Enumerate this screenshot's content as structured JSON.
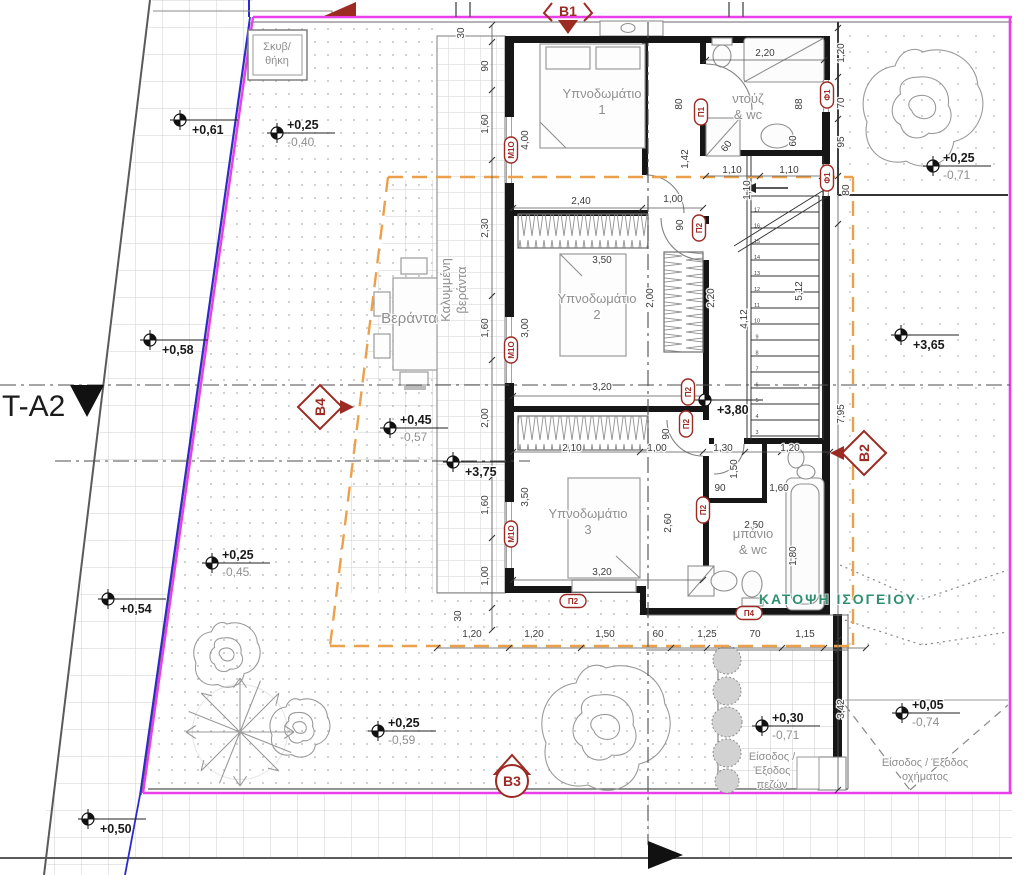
{
  "drawing": {
    "plan_title": "ΚΑΤΟΨΗ ΙΣΟΓΕΙΟΥ",
    "section_line_label": "T-A2",
    "colors": {
      "boundary": "#e93ee9",
      "setback": "#eda04b",
      "section_marker": "#9c2b24",
      "title_green": "#2f9070",
      "parcel_blue": "#2a2ad0"
    },
    "rooms": [
      {
        "name": "bedroom-1",
        "lines": [
          "Υπνοδωμάτιο",
          "1"
        ],
        "x": 602,
        "y": 98
      },
      {
        "name": "shower-wc",
        "lines": [
          "ντούζ",
          "& wc"
        ],
        "x": 748,
        "y": 103
      },
      {
        "name": "bedroom-2",
        "lines": [
          "Υπνοδωμάτιο",
          "2"
        ],
        "x": 597,
        "y": 303
      },
      {
        "name": "bedroom-3",
        "lines": [
          "Υπνοδωμάτιο",
          "3"
        ],
        "x": 588,
        "y": 518
      },
      {
        "name": "bath-wc",
        "lines": [
          "μπάνιο",
          "& wc"
        ],
        "x": 753,
        "y": 538
      },
      {
        "name": "veranda",
        "lines": [
          "Βεράντα"
        ],
        "x": 409,
        "y": 323,
        "cls": "room-lg"
      },
      {
        "name": "covered-veranda",
        "lines": [
          "Καλυμμένη",
          "βεράντα"
        ],
        "x": 450,
        "y": 290,
        "rot": -90
      },
      {
        "name": "storage",
        "lines": [
          "Σκυβ/",
          "θήκη"
        ],
        "x": 277,
        "y": 50,
        "cls": "small-gray"
      }
    ],
    "entrances": [
      {
        "name": "pedestrian-entrance",
        "lines": [
          "Είσοδος /",
          "Έξοδος",
          "πεζών"
        ],
        "x": 772,
        "y": 760
      },
      {
        "name": "vehicle-entrance",
        "lines": [
          "Είσοδος / Έξοδος",
          "οχήματος"
        ],
        "x": 925,
        "y": 766
      }
    ],
    "dimensions": [
      {
        "t": "30",
        "x": 464,
        "y": 33,
        "r": -90
      },
      {
        "t": "90",
        "x": 488,
        "y": 66,
        "r": -90
      },
      {
        "t": "1,60",
        "x": 488,
        "y": 124,
        "r": -90
      },
      {
        "t": "2,30",
        "x": 488,
        "y": 228,
        "r": -90
      },
      {
        "t": "1,60",
        "x": 488,
        "y": 328,
        "r": -90
      },
      {
        "t": "2,00",
        "x": 488,
        "y": 418,
        "r": -90
      },
      {
        "t": "1,60",
        "x": 488,
        "y": 505,
        "r": -90
      },
      {
        "t": "1,00",
        "x": 488,
        "y": 576,
        "r": -90
      },
      {
        "t": "30",
        "x": 461,
        "y": 616,
        "r": -90
      },
      {
        "t": "4,00",
        "x": 528,
        "y": 140,
        "r": -90
      },
      {
        "t": "3,00",
        "x": 528,
        "y": 328,
        "r": -90
      },
      {
        "t": "3,50",
        "x": 528,
        "y": 497,
        "r": -90
      },
      {
        "t": "2,40",
        "x": 581,
        "y": 204
      },
      {
        "t": "1,00",
        "x": 673,
        "y": 202
      },
      {
        "t": "2,20",
        "x": 765,
        "y": 56
      },
      {
        "t": "80",
        "x": 682,
        "y": 104,
        "r": -90
      },
      {
        "t": "88",
        "x": 802,
        "y": 104,
        "r": -90
      },
      {
        "t": "60",
        "x": 796,
        "y": 141,
        "r": -90
      },
      {
        "t": "60",
        "x": 729,
        "y": 148,
        "r": -55
      },
      {
        "t": "1,42",
        "x": 688,
        "y": 159,
        "r": -90
      },
      {
        "t": "1,10",
        "x": 732,
        "y": 173
      },
      {
        "t": "1,10",
        "x": 789,
        "y": 173
      },
      {
        "t": "1,10",
        "x": 750,
        "y": 190,
        "r": -90
      },
      {
        "t": "90",
        "x": 683,
        "y": 225,
        "r": -90
      },
      {
        "t": "3,50",
        "x": 602,
        "y": 263
      },
      {
        "t": "2,00",
        "x": 653,
        "y": 298,
        "r": -90
      },
      {
        "t": "2,20",
        "x": 714,
        "y": 298,
        "r": -90
      },
      {
        "t": "4,12",
        "x": 747,
        "y": 319,
        "r": -90
      },
      {
        "t": "5,12",
        "x": 802,
        "y": 291,
        "r": -90
      },
      {
        "t": "3,20",
        "x": 602,
        "y": 390
      },
      {
        "t": "90",
        "x": 669,
        "y": 434,
        "r": -90
      },
      {
        "t": "2,10",
        "x": 572,
        "y": 451
      },
      {
        "t": "1,00",
        "x": 657,
        "y": 451
      },
      {
        "t": "1,30",
        "x": 723,
        "y": 451
      },
      {
        "t": "1,20",
        "x": 790,
        "y": 451
      },
      {
        "t": "1,50",
        "x": 737,
        "y": 469,
        "r": -90
      },
      {
        "t": "90",
        "x": 720,
        "y": 491
      },
      {
        "t": "1,60",
        "x": 779,
        "y": 491
      },
      {
        "t": "2,50",
        "x": 754,
        "y": 528
      },
      {
        "t": "1,80",
        "x": 796,
        "y": 556,
        "r": -90
      },
      {
        "t": "2,60",
        "x": 671,
        "y": 523,
        "r": -90
      },
      {
        "t": "3,20",
        "x": 602,
        "y": 575
      },
      {
        "t": "1,20",
        "x": 472,
        "y": 637
      },
      {
        "t": "1,20",
        "x": 534,
        "y": 637
      },
      {
        "t": "1,50",
        "x": 605,
        "y": 637
      },
      {
        "t": "60",
        "x": 658,
        "y": 637
      },
      {
        "t": "1,25",
        "x": 707,
        "y": 637
      },
      {
        "t": "70",
        "x": 755,
        "y": 637
      },
      {
        "t": "1,15",
        "x": 805,
        "y": 637
      },
      {
        "t": "1,20",
        "x": 844,
        "y": 53,
        "r": -90
      },
      {
        "t": "70",
        "x": 844,
        "y": 103,
        "r": -90
      },
      {
        "t": "95",
        "x": 844,
        "y": 142,
        "r": -90
      },
      {
        "t": "80",
        "x": 849,
        "y": 190,
        "r": -90
      },
      {
        "t": "7,95",
        "x": 844,
        "y": 414,
        "r": -90
      },
      {
        "t": "3,42",
        "x": 844,
        "y": 709,
        "r": -90
      }
    ],
    "elevation_points": [
      {
        "p": "+0,61",
        "m": "",
        "x": 180,
        "y": 120
      },
      {
        "p": "+0,25",
        "m": "-0,40",
        "x": 277,
        "y": 133
      },
      {
        "p": "+0,58",
        "m": "",
        "x": 150,
        "y": 340
      },
      {
        "p": "+0,45",
        "m": "-0,57",
        "x": 390,
        "y": 428
      },
      {
        "p": "+3,75",
        "m": "",
        "x": 453,
        "y": 462
      },
      {
        "p": "+3,80",
        "m": "",
        "x": 705,
        "y": 400
      },
      {
        "p": "+3,65",
        "m": "",
        "x": 901,
        "y": 335
      },
      {
        "p": "+0,25",
        "m": "-0,71",
        "x": 933,
        "y": 166
      },
      {
        "p": "+0,25",
        "m": "-0,45",
        "x": 212,
        "y": 563
      },
      {
        "p": "+0,54",
        "m": "",
        "x": 108,
        "y": 599
      },
      {
        "p": "+0,25",
        "m": "-0,59",
        "x": 378,
        "y": 731
      },
      {
        "p": "+0,30",
        "m": "-0,71",
        "x": 762,
        "y": 726
      },
      {
        "p": "+0,05",
        "m": "-0,74",
        "x": 902,
        "y": 713
      },
      {
        "p": "+0,50",
        "m": "",
        "x": 88,
        "y": 819
      }
    ],
    "section_markers": [
      {
        "label": "Β1",
        "x": 568,
        "y": 10,
        "shape": "top"
      },
      {
        "label": "Β2",
        "x": 864,
        "y": 453,
        "shape": "right"
      },
      {
        "label": "Β3",
        "x": 512,
        "y": 781,
        "shape": "bottom"
      },
      {
        "label": "Β4",
        "x": 320,
        "y": 407,
        "shape": "left"
      }
    ],
    "opening_markers": [
      {
        "t": "Μ1Ο",
        "x": 511,
        "y": 150,
        "r": -90
      },
      {
        "t": "Μ1Ο",
        "x": 511,
        "y": 350,
        "r": -90
      },
      {
        "t": "Μ1Ο",
        "x": 511,
        "y": 534,
        "r": -90
      },
      {
        "t": "Π1",
        "x": 701,
        "y": 112,
        "r": -90
      },
      {
        "t": "Π2",
        "x": 699,
        "y": 228,
        "r": -90
      },
      {
        "t": "Π2",
        "x": 688,
        "y": 392,
        "r": -90
      },
      {
        "t": "Π2",
        "x": 686,
        "y": 424,
        "r": -90
      },
      {
        "t": "Π2",
        "x": 703,
        "y": 510,
        "r": -90
      },
      {
        "t": "Π2",
        "x": 573,
        "y": 601,
        "r": 0
      },
      {
        "t": "Φ1",
        "x": 827,
        "y": 95,
        "r": -90
      },
      {
        "t": "Φ1",
        "x": 827,
        "y": 178,
        "r": -90
      },
      {
        "t": "Π4",
        "x": 749,
        "y": 613,
        "r": 0
      }
    ],
    "stair_step_numbers": {
      "from": 3,
      "to": 17
    }
  }
}
